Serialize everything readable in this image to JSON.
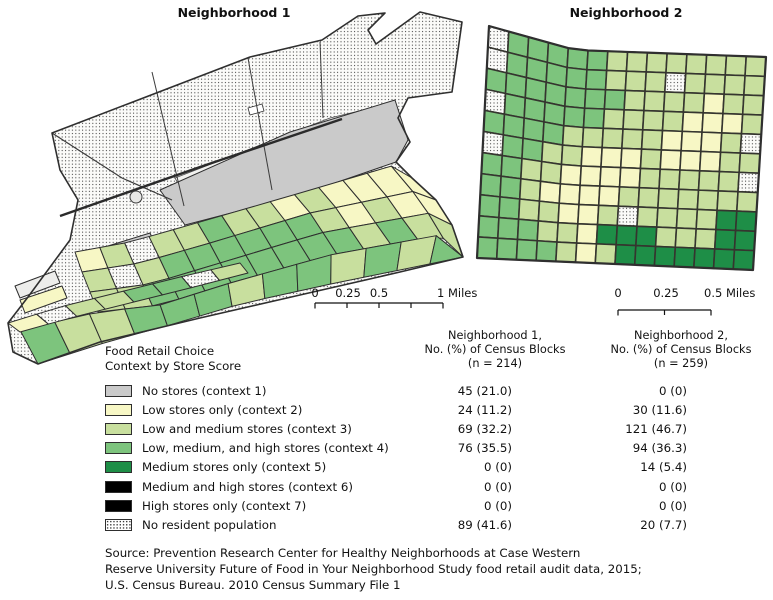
{
  "figure": {
    "map1_title": "Neighborhood 1",
    "map2_title": "Neighborhood 2"
  },
  "scalebar1": {
    "t0": "0",
    "t1": "0.25",
    "t2": "0.5",
    "t3": "1 Miles"
  },
  "scalebar2": {
    "t0": "0",
    "t1": "0.25",
    "t2": "0.5 Miles"
  },
  "legend": {
    "heading_line1": "Food Retail Choice",
    "heading_line2": "Context by Store Score",
    "col1_header_line1": "Neighborhood 1,",
    "col1_header_line2": "No. (%) of Census Blocks",
    "col1_header_line3": "(n = 214)",
    "col2_header_line1": "Neighborhood 2,",
    "col2_header_line2": "No. (%) of Census Blocks",
    "col2_header_line3": "(n = 259)",
    "rows": [
      {
        "label": "No stores (context 1)",
        "n1": "45 (21.0)",
        "n2": "0 (0)",
        "swatch": "context1"
      },
      {
        "label": "Low stores only (context 2)",
        "n1": "24 (11.2)",
        "n2": "30 (11.6)",
        "swatch": "context2"
      },
      {
        "label": "Low and medium stores (context 3)",
        "n1": "69 (32.2)",
        "n2": "121 (46.7)",
        "swatch": "context3"
      },
      {
        "label": "Low, medium, and high stores (context 4)",
        "n1": "76 (35.5)",
        "n2": "94 (36.3)",
        "swatch": "context4"
      },
      {
        "label": "Medium stores only (context 5)",
        "n1": "0 (0)",
        "n2": "14 (5.4)",
        "swatch": "context5"
      },
      {
        "label": "Medium and high stores (context 6)",
        "n1": "0 (0)",
        "n2": "0 (0)",
        "swatch": "context6"
      },
      {
        "label": "High stores only (context 7)",
        "n1": "0 (0)",
        "n2": "0 (0)",
        "swatch": "context7"
      },
      {
        "label": "No resident population",
        "n1": "89 (41.6)",
        "n2": "20 (7.7)",
        "swatch": "dotted"
      }
    ]
  },
  "source_line1": "Source: Prevention Research Center for Healthy Neighborhoods at Case Western",
  "source_line2": "Reserve University Future of Food in Your Neighborhood Study food retail audit data, 2015;",
  "source_line3": "U.S. Census Bureau. 2010 Census Summary File 1",
  "palette": {
    "context1": "#cacaca",
    "context2": "#f7f7c5",
    "context3": "#c8df9e",
    "context4": "#7dc47d",
    "context5": "#1e8e47",
    "context6": "#000000",
    "context7": "#000000",
    "no_population_bg": "#fbfbf9",
    "dot_color": "#3c3c3c",
    "block_border": "#2e2e2e",
    "grid_border": "#35352f"
  },
  "map1": {
    "bands": [
      {
        "blocks": "23833433232222"
      },
      {
        "blocks": "38344444432322"
      },
      {
        "blocks": "33444444443433"
      },
      {
        "blocks": "4334443443434"
      },
      {
        "blocks": "28334483"
      }
    ]
  },
  "map2": {
    "grid": [
      "84444433333333",
      "84444433383333",
      "44444443333233",
      "84444433332223",
      "44443333322238",
      "84433222322233",
      "44332222333338",
      "44322223333333",
      "44332238333355",
      "44433255533355",
      "44443235555555"
    ]
  }
}
